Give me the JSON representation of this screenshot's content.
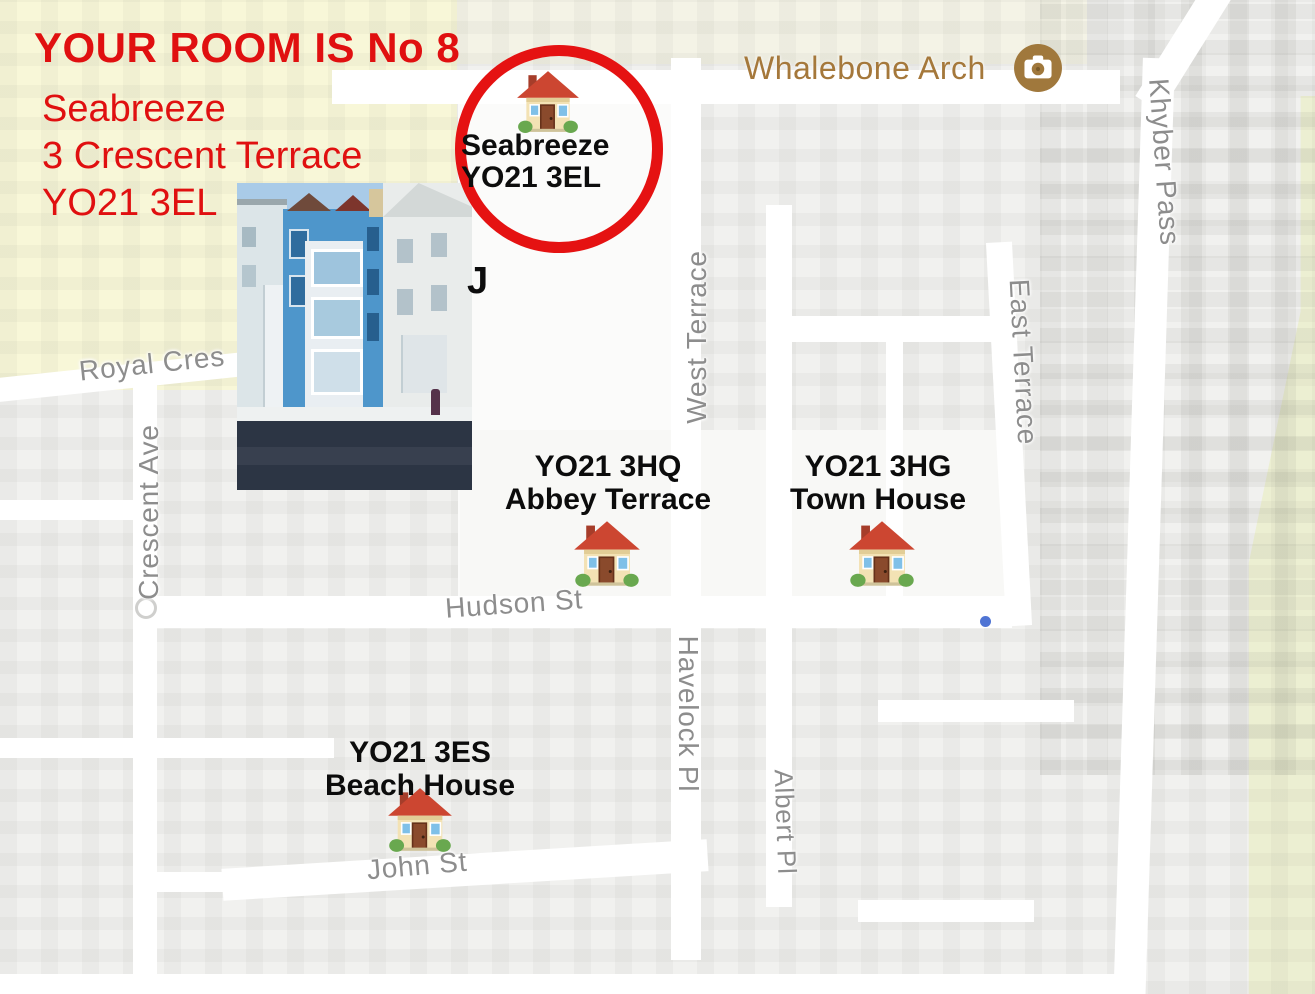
{
  "header": {
    "heading": "YOUR ROOM IS No 8",
    "address_lines": [
      "Seabreeze",
      "3 Crescent Terrace",
      "YO21 3EL"
    ]
  },
  "target": {
    "label_line1": "Seabreeze",
    "label_line2": "YO21 3EL",
    "hidden_fragment": "J"
  },
  "poi": {
    "name": "Whalebone Arch",
    "icon": "camera-icon"
  },
  "properties": [
    {
      "postcode": "YO21 3HQ",
      "name": "Abbey Terrace"
    },
    {
      "postcode": "YO21 3HG",
      "name": "Town House"
    },
    {
      "postcode": "YO21 3ES",
      "name": "Beach House"
    }
  ],
  "streets": {
    "royal_cres": "Royal Cres",
    "crescent_ave": "Crescent Ave",
    "west_terrace": "West Terrace",
    "east_terrace": "East Terrace",
    "khyber_pass": "Khyber Pass",
    "hudson_st": "Hudson St",
    "havelock_pl": "Havelock Pl",
    "albert_pl": "Albert Pl",
    "john_st": "John St"
  },
  "icons": {
    "house": "house-icon",
    "camera": "camera-icon"
  },
  "colors": {
    "annotation_red": "#e01010",
    "circle_red": "#e51212",
    "park_yellow": "#f8f7d8",
    "greenway_yellow": "#ecefd2",
    "map_background": "#f1f1ef",
    "street_white": "#ffffff",
    "street_label_gray": "#8d8d8d",
    "poi_brown": "#a5783b",
    "label_black": "#0c0c0c"
  }
}
